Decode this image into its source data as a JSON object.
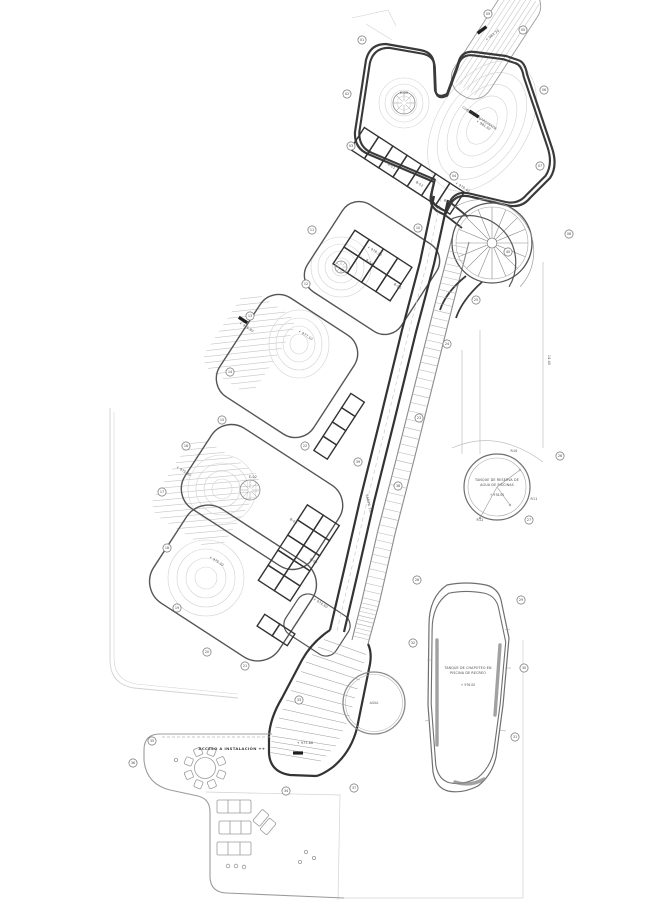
{
  "document": {
    "type": "architectural-site-plan",
    "background": "#ffffff"
  },
  "palette": {
    "wall": "#333333",
    "medium_line": "#6f6f6f",
    "light_line": "#9c9c9c",
    "faint_line": "#d2d2d2",
    "hatch": "#c6c6c6",
    "text": "#4a4a4a",
    "chip": "#1e1e1e",
    "paper": "#ffffff"
  },
  "labels": {
    "pool": {
      "line1": "TANQUE DE CHAPOTEO EN",
      "line2": "PISCINA DE RECREO",
      "elevation": "+ 976.00"
    },
    "tank": {
      "line1": "TANQUE DE RESERVA DE",
      "line2": "AGUA DE PISCINAS",
      "elevation": "+ 978.00"
    },
    "terrace": {
      "access": "ACCESO A INSTALACIÓN ++"
    },
    "pond": {
      "label": "AGUA"
    }
  },
  "plan_labels": [
    {
      "x": 479,
      "y": 119,
      "t": "CUBIERTA AJARDINADA",
      "r": 33
    },
    {
      "x": 483,
      "y": 126,
      "t": "+ 981.60",
      "r": 33
    },
    {
      "x": 493,
      "y": 36,
      "t": "+ 983.20",
      "r": -37
    },
    {
      "x": 462,
      "y": 188,
      "t": "+ 979.40",
      "r": 33
    },
    {
      "x": 404,
      "y": 94,
      "t": "E-03",
      "r": 0
    },
    {
      "x": 374,
      "y": 252,
      "t": "+ 978.20",
      "r": 33
    },
    {
      "x": 305,
      "y": 336,
      "t": "+ 977.10",
      "r": 33
    },
    {
      "x": 246,
      "y": 328,
      "t": "+ 976.80",
      "r": 33
    },
    {
      "x": 183,
      "y": 472,
      "t": "+ 975.90",
      "r": 33
    },
    {
      "x": 216,
      "y": 562,
      "t": "+ 975.30",
      "r": 33
    },
    {
      "x": 253,
      "y": 478,
      "t": "E-02",
      "r": 0
    },
    {
      "x": 320,
      "y": 604,
      "t": "+ 974.60",
      "r": 33
    },
    {
      "x": 305,
      "y": 744,
      "t": "+ 973.80",
      "r": 0
    },
    {
      "x": 391,
      "y": 167,
      "t": "B-01",
      "r": 33
    },
    {
      "x": 419,
      "y": 185,
      "t": "B-02",
      "r": 33
    },
    {
      "x": 447,
      "y": 203,
      "t": "B-03",
      "r": 33
    },
    {
      "x": 369,
      "y": 263,
      "t": "B-04",
      "r": 33
    },
    {
      "x": 397,
      "y": 287,
      "t": "B-05",
      "r": 33
    },
    {
      "x": 293,
      "y": 522,
      "t": "B-06",
      "r": 33
    },
    {
      "x": 313,
      "y": 562,
      "t": "B-07",
      "r": 33
    },
    {
      "x": 514,
      "y": 452,
      "t": "R10",
      "r": 0
    },
    {
      "x": 534,
      "y": 500,
      "t": "R11",
      "r": 0
    },
    {
      "x": 480,
      "y": 521,
      "t": "R12",
      "r": 0
    },
    {
      "x": 548,
      "y": 360,
      "t": "14.40",
      "r": 90
    },
    {
      "x": 368,
      "y": 505,
      "t": "RAMPA 10%",
      "r": 77
    }
  ],
  "callouts": [
    {
      "x": 362,
      "y": 40,
      "n": "01"
    },
    {
      "x": 347,
      "y": 94,
      "n": "02"
    },
    {
      "x": 351,
      "y": 146,
      "n": "03"
    },
    {
      "x": 454,
      "y": 176,
      "n": "04"
    },
    {
      "x": 523,
      "y": 30,
      "n": "05"
    },
    {
      "x": 544,
      "y": 90,
      "n": "06"
    },
    {
      "x": 540,
      "y": 166,
      "n": "07"
    },
    {
      "x": 569,
      "y": 234,
      "n": "08"
    },
    {
      "x": 488,
      "y": 14,
      "n": "09"
    },
    {
      "x": 418,
      "y": 228,
      "n": "10"
    },
    {
      "x": 312,
      "y": 230,
      "n": "11"
    },
    {
      "x": 306,
      "y": 284,
      "n": "12"
    },
    {
      "x": 250,
      "y": 316,
      "n": "13"
    },
    {
      "x": 230,
      "y": 372,
      "n": "14"
    },
    {
      "x": 222,
      "y": 420,
      "n": "15"
    },
    {
      "x": 186,
      "y": 446,
      "n": "16"
    },
    {
      "x": 162,
      "y": 492,
      "n": "17"
    },
    {
      "x": 167,
      "y": 548,
      "n": "18"
    },
    {
      "x": 177,
      "y": 608,
      "n": "19"
    },
    {
      "x": 207,
      "y": 652,
      "n": "20"
    },
    {
      "x": 245,
      "y": 666,
      "n": "21"
    },
    {
      "x": 305,
      "y": 446,
      "n": "22"
    },
    {
      "x": 419,
      "y": 418,
      "n": "23"
    },
    {
      "x": 447,
      "y": 344,
      "n": "24"
    },
    {
      "x": 476,
      "y": 300,
      "n": "25"
    },
    {
      "x": 560,
      "y": 456,
      "n": "26"
    },
    {
      "x": 529,
      "y": 520,
      "n": "27"
    },
    {
      "x": 417,
      "y": 580,
      "n": "28"
    },
    {
      "x": 521,
      "y": 600,
      "n": "29"
    },
    {
      "x": 524,
      "y": 668,
      "n": "30"
    },
    {
      "x": 515,
      "y": 737,
      "n": "31"
    },
    {
      "x": 413,
      "y": 643,
      "n": "32"
    },
    {
      "x": 299,
      "y": 700,
      "n": "33"
    },
    {
      "x": 286,
      "y": 791,
      "n": "34"
    },
    {
      "x": 152,
      "y": 741,
      "n": "35"
    },
    {
      "x": 133,
      "y": 763,
      "n": "36"
    },
    {
      "x": 354,
      "y": 788,
      "n": "37"
    },
    {
      "x": 398,
      "y": 486,
      "n": "38"
    },
    {
      "x": 358,
      "y": 462,
      "n": "39"
    },
    {
      "x": 508,
      "y": 252,
      "n": "40"
    }
  ]
}
